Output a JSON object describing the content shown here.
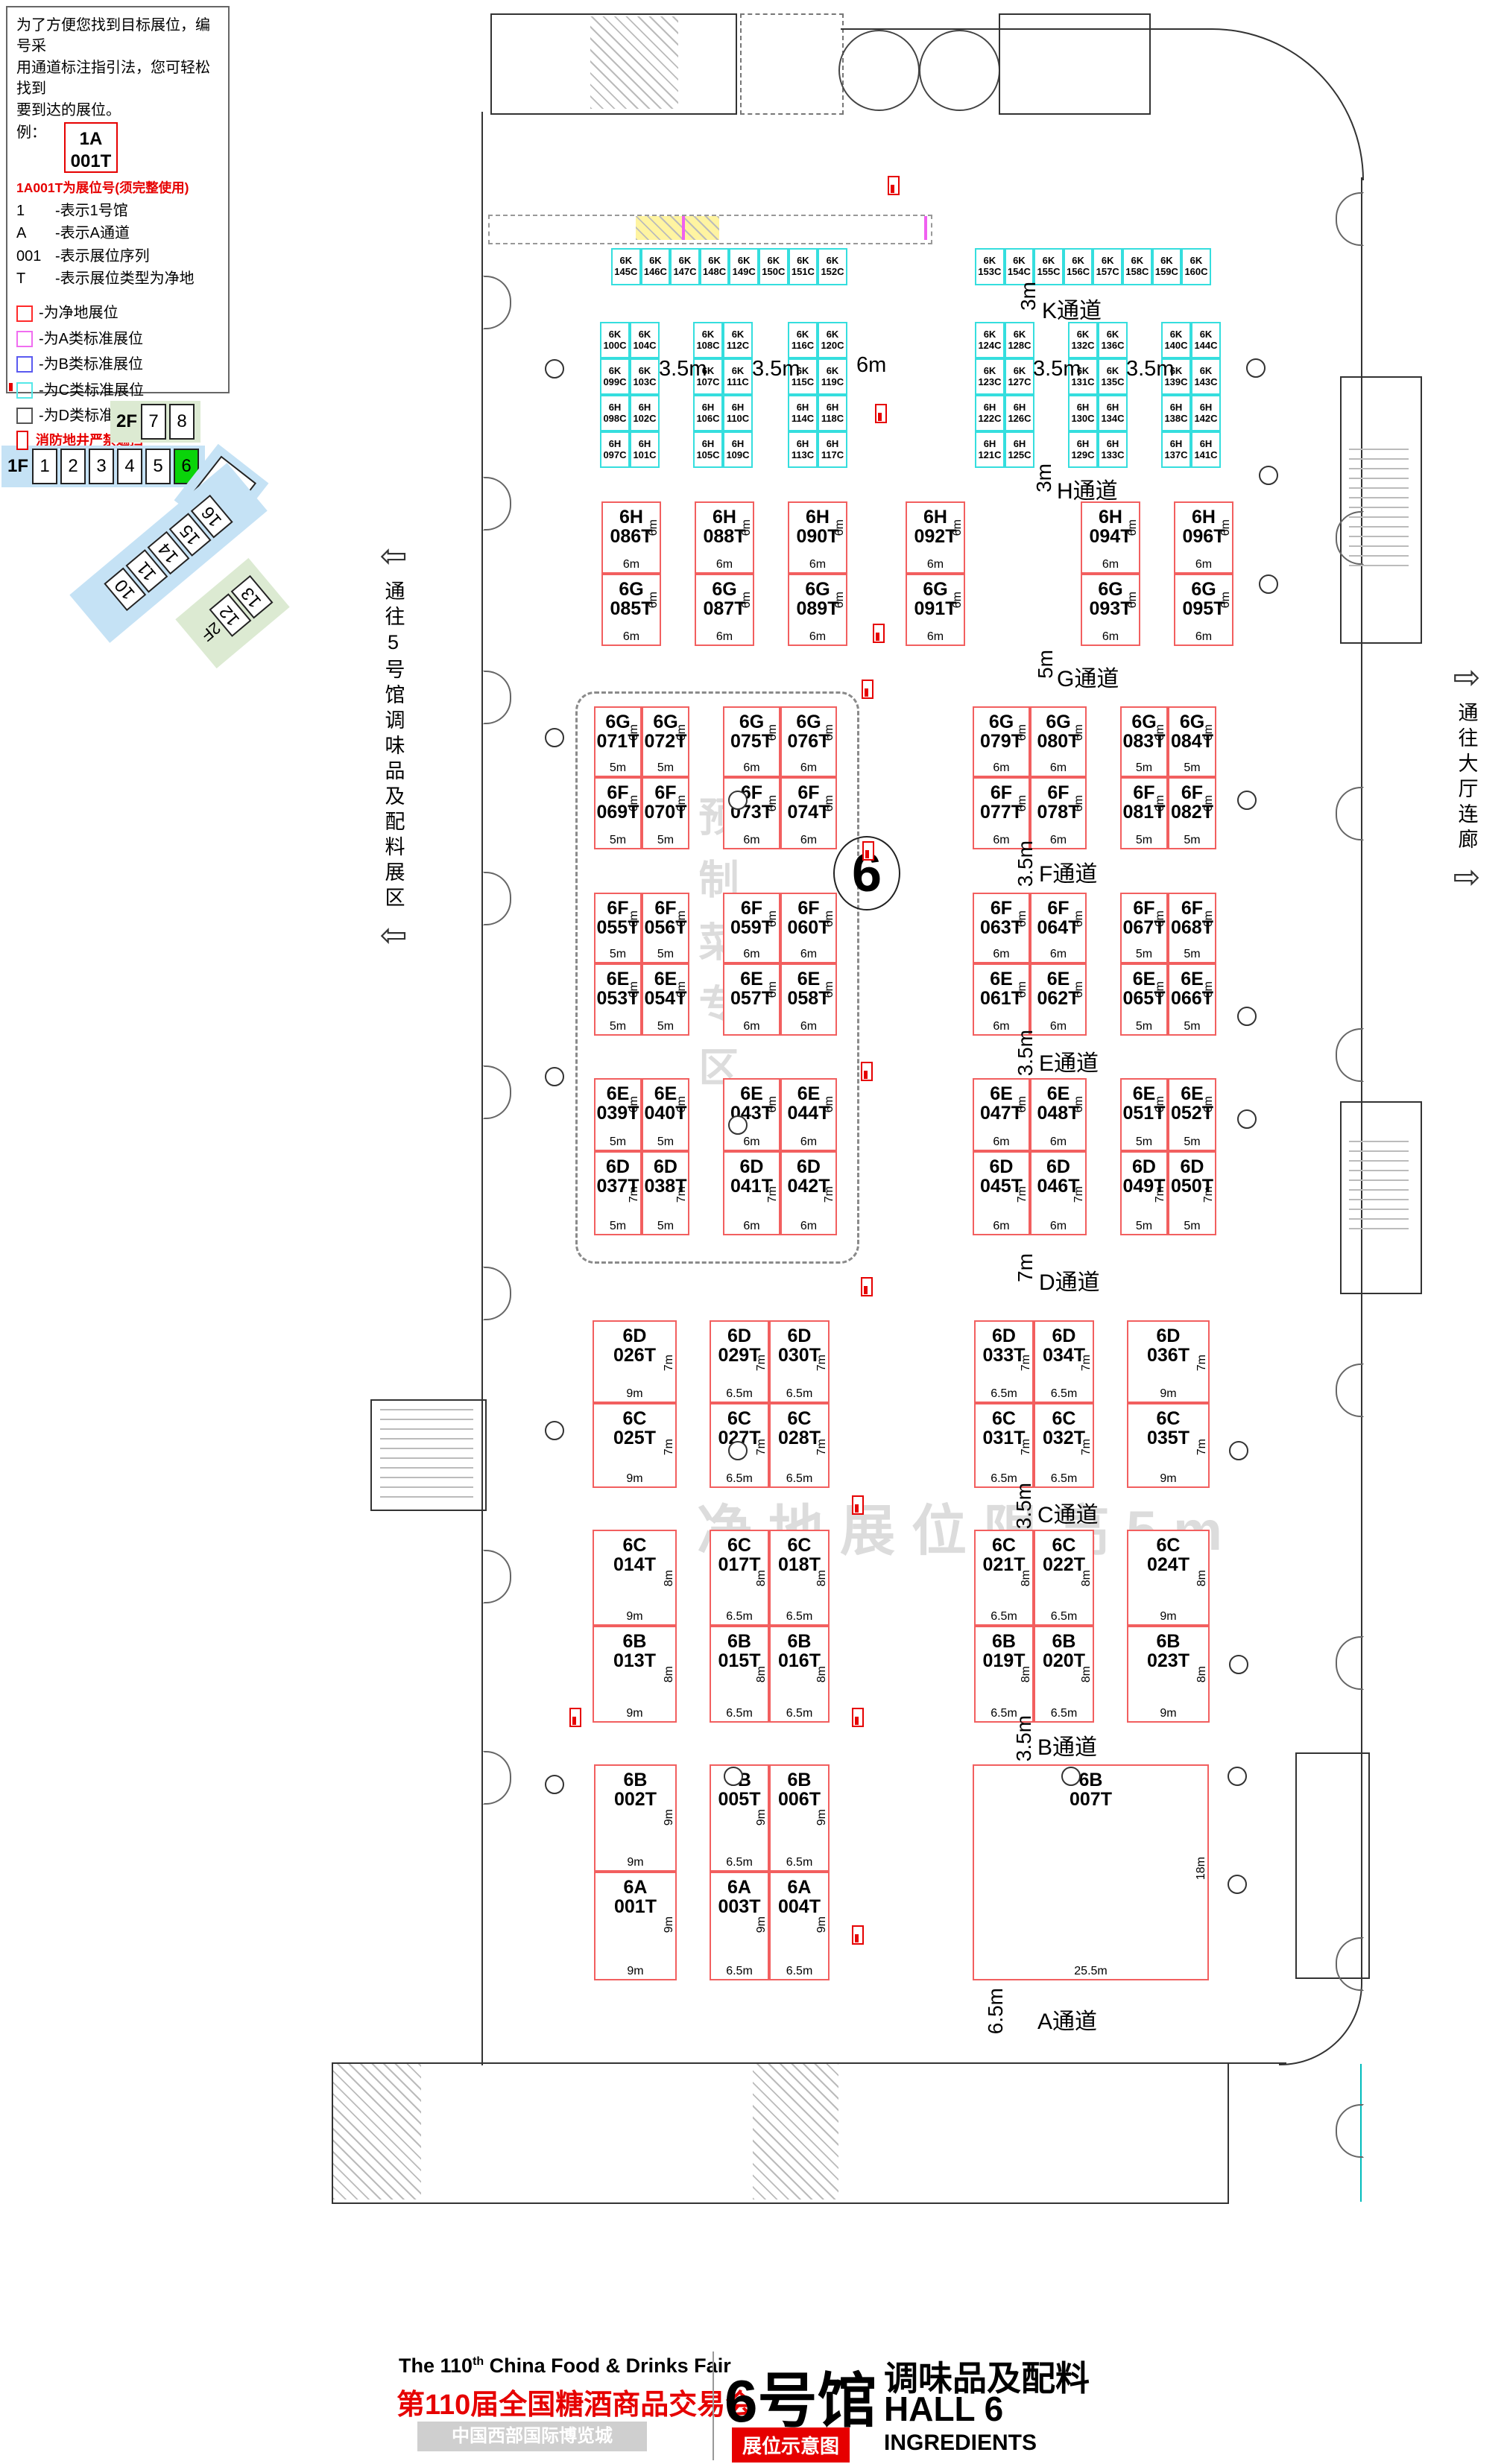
{
  "legend": {
    "intro": [
      "为了方便您找到目标展位，编号采",
      "用通道标注指引法，您可轻松找到",
      "要到达的展位。"
    ],
    "example_label": "例：",
    "example": {
      "l1": "1A",
      "l2": "001T"
    },
    "example_note": "1A001T为展位号(须完整使用)",
    "codes": [
      {
        "key": "1",
        "desc": "-表示1号馆"
      },
      {
        "key": "A",
        "desc": "-表示A通道"
      },
      {
        "key": "001",
        "desc": "-表示展位序列"
      },
      {
        "key": "T",
        "desc": "-表示展位类型为净地"
      }
    ],
    "types": [
      {
        "label": "-为净地展位",
        "color": "#ff2a2a"
      },
      {
        "label": "-为A类标准展位",
        "color": "#f06df0"
      },
      {
        "label": "-为B类标准展位",
        "color": "#5a5af0"
      },
      {
        "label": "-为C类标准展位",
        "color": "#55e8e8"
      },
      {
        "label": "-为D类标准展位",
        "color": "#555555"
      }
    ],
    "fire_note": "消防地井严禁遮挡",
    "pillar_note": "展位内立柱 直径均为1.5m"
  },
  "minimap": {
    "f2": {
      "label": "2F",
      "halls": [
        "7",
        "8"
      ]
    },
    "f1": {
      "label": "1F",
      "halls": [
        "1",
        "2",
        "3",
        "4",
        "5",
        "6"
      ],
      "active": "6"
    },
    "nine": "9",
    "diag": [
      "10",
      "11",
      "14",
      "15",
      "16"
    ],
    "green": {
      "label": "2F",
      "halls": [
        "12",
        "13"
      ]
    }
  },
  "side": {
    "left": "通往5号馆调味品及配料展区",
    "right": "通往大厅连廊"
  },
  "wm": {
    "zone": "预制菜专区",
    "limit": "净地展位限高5m"
  },
  "hall_circle": "6",
  "top_gaps": [
    "3.5m",
    "3.5m",
    "6m",
    "3.5m",
    "3.5m"
  ],
  "aisles": [
    {
      "id": "K",
      "name": "K通道",
      "width": "3m"
    },
    {
      "id": "H",
      "name": "H通道",
      "width": "3m"
    },
    {
      "id": "G",
      "name": "G通道",
      "width": "5m"
    },
    {
      "id": "F",
      "name": "F通道",
      "width": "3.5m"
    },
    {
      "id": "E",
      "name": "E通道",
      "width": "3.5m"
    },
    {
      "id": "D",
      "name": "D通道",
      "width": "7m"
    },
    {
      "id": "C",
      "name": "C通道",
      "width": "3.5m"
    },
    {
      "id": "B",
      "name": "B通道",
      "width": "3.5m"
    },
    {
      "id": "A",
      "name": "A通道",
      "width": "6.5m"
    }
  ],
  "booth_groups": [
    {
      "id": "K1",
      "cls": "cy",
      "rows": [
        {
          "cells": [
            "6K145C",
            "6K146C",
            "6K147C",
            "6K148C",
            "6K149C",
            "6K150C",
            "6K151C",
            "6K152C"
          ]
        }
      ]
    },
    {
      "id": "K2",
      "cls": "cy",
      "rows": [
        {
          "cells": [
            "6K153C",
            "6K154C",
            "6K155C",
            "6K156C",
            "6K157C",
            "6K158C",
            "6K159C",
            "6K160C"
          ]
        }
      ]
    },
    {
      "id": "C1",
      "cls": "cy",
      "rows": [
        {
          "cells": [
            "6K100C",
            "6K104C"
          ]
        },
        {
          "cells": [
            "6K099C",
            "6K103C"
          ]
        },
        {
          "cells": [
            "6H098C",
            "6H102C"
          ]
        },
        {
          "cells": [
            "6H097C",
            "6H101C"
          ]
        }
      ]
    },
    {
      "id": "C2",
      "cls": "cy",
      "rows": [
        {
          "cells": [
            "6K108C",
            "6K112C"
          ]
        },
        {
          "cells": [
            "6K107C",
            "6K111C"
          ]
        },
        {
          "cells": [
            "6H106C",
            "6H110C"
          ]
        },
        {
          "cells": [
            "6H105C",
            "6H109C"
          ]
        }
      ]
    },
    {
      "id": "C3",
      "cls": "cy",
      "rows": [
        {
          "cells": [
            "6K116C",
            "6K120C"
          ]
        },
        {
          "cells": [
            "6K115C",
            "6K119C"
          ]
        },
        {
          "cells": [
            "6H114C",
            "6H118C"
          ]
        },
        {
          "cells": [
            "6H113C",
            "6H117C"
          ]
        }
      ]
    },
    {
      "id": "C4",
      "cls": "cy",
      "rows": [
        {
          "cells": [
            "6K124C",
            "6K128C"
          ]
        },
        {
          "cells": [
            "6K123C",
            "6K127C"
          ]
        },
        {
          "cells": [
            "6H122C",
            "6H126C"
          ]
        },
        {
          "cells": [
            "6H121C",
            "6H125C"
          ]
        }
      ]
    },
    {
      "id": "C5",
      "cls": "cy",
      "rows": [
        {
          "cells": [
            "6K132C",
            "6K136C"
          ]
        },
        {
          "cells": [
            "6K131C",
            "6K135C"
          ]
        },
        {
          "cells": [
            "6H130C",
            "6H134C"
          ]
        },
        {
          "cells": [
            "6H129C",
            "6H133C"
          ]
        }
      ]
    },
    {
      "id": "C6",
      "cls": "cy",
      "rows": [
        {
          "cells": [
            "6K140C",
            "6K144C"
          ]
        },
        {
          "cells": [
            "6K139C",
            "6K143C"
          ]
        },
        {
          "cells": [
            "6H138C",
            "6H142C"
          ]
        },
        {
          "cells": [
            "6H137C",
            "6H141C"
          ]
        }
      ]
    },
    {
      "id": "HG1",
      "cls": "rt",
      "rows": [
        {
          "cells": [
            "6H086T"
          ],
          "s": "6m",
          "b": "6m"
        },
        {
          "cells": [
            "6G085T"
          ],
          "s": "6m",
          "b": "6m"
        }
      ]
    },
    {
      "id": "HG2",
      "cls": "rt",
      "rows": [
        {
          "cells": [
            "6H088T"
          ],
          "s": "6m",
          "b": "6m"
        },
        {
          "cells": [
            "6G087T"
          ],
          "s": "6m",
          "b": "6m"
        }
      ]
    },
    {
      "id": "HG3",
      "cls": "rt",
      "rows": [
        {
          "cells": [
            "6H090T"
          ],
          "s": "6m",
          "b": "6m"
        },
        {
          "cells": [
            "6G089T"
          ],
          "s": "6m",
          "b": "6m"
        }
      ]
    },
    {
      "id": "HG4",
      "cls": "rt",
      "rows": [
        {
          "cells": [
            "6H092T"
          ],
          "s": "6m",
          "b": "6m"
        },
        {
          "cells": [
            "6G091T"
          ],
          "s": "6m",
          "b": "6m"
        }
      ]
    },
    {
      "id": "HG5",
      "cls": "rt",
      "rows": [
        {
          "cells": [
            "6H094T"
          ],
          "s": "6m",
          "b": "6m"
        },
        {
          "cells": [
            "6G093T"
          ],
          "s": "6m",
          "b": "6m"
        }
      ]
    },
    {
      "id": "HG6",
      "cls": "rt",
      "rows": [
        {
          "cells": [
            "6H096T"
          ],
          "s": "6m",
          "b": "6m"
        },
        {
          "cells": [
            "6G095T"
          ],
          "s": "6m",
          "b": "6m"
        }
      ]
    },
    {
      "id": "GF1",
      "cls": "rt",
      "rows": [
        {
          "cells": [
            "6G071T",
            "6G072T"
          ],
          "s": "6m",
          "b": "5m"
        },
        {
          "cells": [
            "6F069T",
            "6F070T"
          ],
          "s": "6m",
          "b": "5m"
        }
      ]
    },
    {
      "id": "GF2",
      "cls": "rt",
      "rows": [
        {
          "cells": [
            "6G075T",
            "6G076T"
          ],
          "s": "6m",
          "b": "6m"
        },
        {
          "cells": [
            "6F073T",
            "6F074T"
          ],
          "s": "6m",
          "b": "6m"
        }
      ]
    },
    {
      "id": "GF3",
      "cls": "rt",
      "rows": [
        {
          "cells": [
            "6G079T",
            "6G080T"
          ],
          "s": "6m",
          "b": "6m"
        },
        {
          "cells": [
            "6F077T",
            "6F078T"
          ],
          "s": "6m",
          "b": "6m"
        }
      ]
    },
    {
      "id": "GF4",
      "cls": "rt",
      "rows": [
        {
          "cells": [
            "6G083T",
            "6G084T"
          ],
          "s": "6m",
          "b": "5m"
        },
        {
          "cells": [
            "6F081T",
            "6F082T"
          ],
          "s": "6m",
          "b": "5m"
        }
      ]
    },
    {
      "id": "FE1",
      "cls": "rt",
      "rows": [
        {
          "cells": [
            "6F055T",
            "6F056T"
          ],
          "s": "6m",
          "b": "5m"
        },
        {
          "cells": [
            "6E053T",
            "6E054T"
          ],
          "s": "6m",
          "b": "5m"
        }
      ]
    },
    {
      "id": "FE2",
      "cls": "rt",
      "rows": [
        {
          "cells": [
            "6F059T",
            "6F060T"
          ],
          "s": "6m",
          "b": "6m"
        },
        {
          "cells": [
            "6E057T",
            "6E058T"
          ],
          "s": "6m",
          "b": "6m"
        }
      ]
    },
    {
      "id": "FE3",
      "cls": "rt",
      "rows": [
        {
          "cells": [
            "6F063T",
            "6F064T"
          ],
          "s": "6m",
          "b": "6m"
        },
        {
          "cells": [
            "6E061T",
            "6E062T"
          ],
          "s": "6m",
          "b": "6m"
        }
      ]
    },
    {
      "id": "FE4",
      "cls": "rt",
      "rows": [
        {
          "cells": [
            "6F067T",
            "6F068T"
          ],
          "s": "6m",
          "b": "5m"
        },
        {
          "cells": [
            "6E065T",
            "6E066T"
          ],
          "s": "6m",
          "b": "5m"
        }
      ]
    },
    {
      "id": "ED1",
      "cls": "rt",
      "rows": [
        {
          "cells": [
            "6E039T",
            "6E040T"
          ],
          "s": "6m",
          "b": "5m"
        },
        {
          "cells": [
            "6D037T",
            "6D038T"
          ],
          "s": "7m",
          "b": "5m"
        }
      ]
    },
    {
      "id": "ED2",
      "cls": "rt",
      "rows": [
        {
          "cells": [
            "6E043T",
            "6E044T"
          ],
          "s": "6m",
          "b": "6m"
        },
        {
          "cells": [
            "6D041T",
            "6D042T"
          ],
          "s": "7m",
          "b": "6m"
        }
      ]
    },
    {
      "id": "ED3",
      "cls": "rt",
      "rows": [
        {
          "cells": [
            "6E047T",
            "6E048T"
          ],
          "s": "6m",
          "b": "6m"
        },
        {
          "cells": [
            "6D045T",
            "6D046T"
          ],
          "s": "7m",
          "b": "6m"
        }
      ]
    },
    {
      "id": "ED4",
      "cls": "rt",
      "rows": [
        {
          "cells": [
            "6E051T",
            "6E052T"
          ],
          "s": "6m",
          "b": "5m"
        },
        {
          "cells": [
            "6D049T",
            "6D050T"
          ],
          "s": "7m",
          "b": "5m"
        }
      ]
    },
    {
      "id": "DC1",
      "cls": "rt",
      "rows": [
        {
          "cells": [
            "6D026T"
          ],
          "s": "7m",
          "b": "9m"
        },
        {
          "cells": [
            "6C025T"
          ],
          "s": "7m",
          "b": "9m"
        }
      ]
    },
    {
      "id": "DC2",
      "cls": "rt",
      "rows": [
        {
          "cells": [
            "6D029T",
            "6D030T"
          ],
          "s": "7m",
          "b": "6.5m"
        },
        {
          "cells": [
            "6C027T",
            "6C028T"
          ],
          "s": "7m",
          "b": "6.5m"
        }
      ]
    },
    {
      "id": "DC3",
      "cls": "rt",
      "rows": [
        {
          "cells": [
            "6D033T",
            "6D034T"
          ],
          "s": "7m",
          "b": "6.5m"
        },
        {
          "cells": [
            "6C031T",
            "6C032T"
          ],
          "s": "7m",
          "b": "6.5m"
        }
      ]
    },
    {
      "id": "DC4",
      "cls": "rt",
      "rows": [
        {
          "cells": [
            "6D036T"
          ],
          "s": "7m",
          "b": "9m"
        },
        {
          "cells": [
            "6C035T"
          ],
          "s": "7m",
          "b": "9m"
        }
      ]
    },
    {
      "id": "CB1",
      "cls": "rt",
      "rows": [
        {
          "cells": [
            "6C014T"
          ],
          "s": "8m",
          "b": "9m"
        },
        {
          "cells": [
            "6B013T"
          ],
          "s": "8m",
          "b": "9m"
        }
      ]
    },
    {
      "id": "CB2",
      "cls": "rt",
      "rows": [
        {
          "cells": [
            "6C017T",
            "6C018T"
          ],
          "s": "8m",
          "b": "6.5m"
        },
        {
          "cells": [
            "6B015T",
            "6B016T"
          ],
          "s": "8m",
          "b": "6.5m"
        }
      ]
    },
    {
      "id": "CB3",
      "cls": "rt",
      "rows": [
        {
          "cells": [
            "6C021T",
            "6C022T"
          ],
          "s": "8m",
          "b": "6.5m"
        },
        {
          "cells": [
            "6B019T",
            "6B020T"
          ],
          "s": "8m",
          "b": "6.5m"
        }
      ]
    },
    {
      "id": "CB4",
      "cls": "rt",
      "rows": [
        {
          "cells": [
            "6C024T"
          ],
          "s": "8m",
          "b": "9m"
        },
        {
          "cells": [
            "6B023T"
          ],
          "s": "8m",
          "b": "9m"
        }
      ]
    },
    {
      "id": "BA1",
      "cls": "rt",
      "rows": [
        {
          "cells": [
            "6B002T"
          ],
          "s": "9m",
          "b": "9m"
        },
        {
          "cells": [
            "6A001T"
          ],
          "s": "9m",
          "b": "9m"
        }
      ]
    },
    {
      "id": "BA2",
      "cls": "rt",
      "rows": [
        {
          "cells": [
            "6B005T",
            "6B006T"
          ],
          "s": "9m",
          "b": "6.5m"
        },
        {
          "cells": [
            "6A003T",
            "6A004T"
          ],
          "s": "9m",
          "b": "6.5m"
        }
      ]
    },
    {
      "id": "B7",
      "cls": "rt",
      "rows": [
        {
          "cells": [
            "6B007T"
          ],
          "s": "18m",
          "b": "25.5m"
        }
      ]
    }
  ],
  "footer": {
    "fair_en_pre": "The 110",
    "fair_en_sup": "th",
    "fair_en_post": " China Food & Drinks Fair",
    "fair_cn": "第110届全国糖酒商品交易会",
    "venue": "中国西部国际博览城",
    "hall_cn": "6号馆",
    "badge": "展位示意图",
    "category_cn": "调味品及配料",
    "hall_en": "HALL 6",
    "category_en": "INGREDIENTS"
  }
}
